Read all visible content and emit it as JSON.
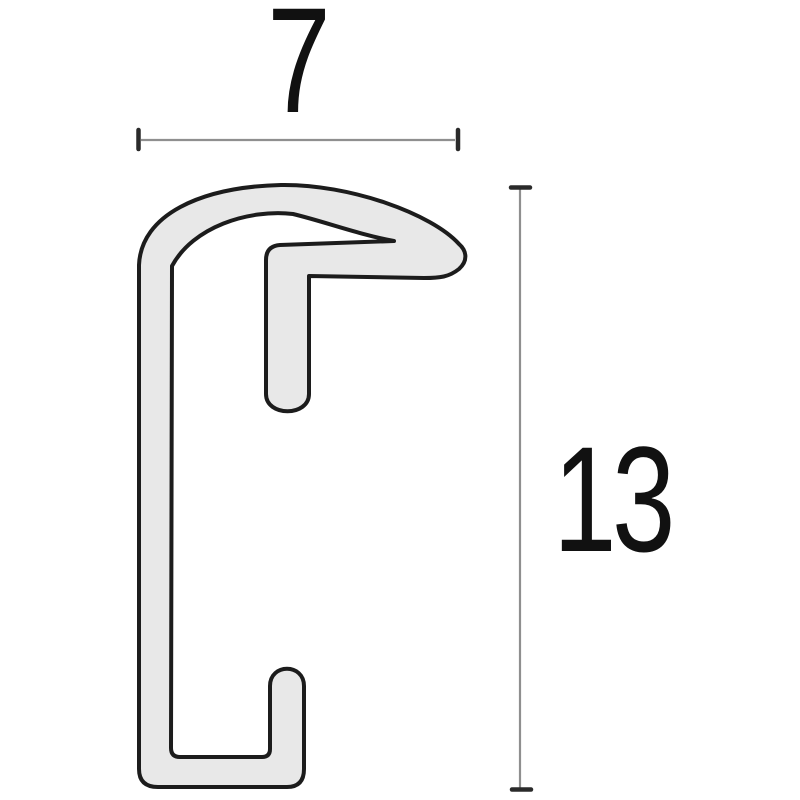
{
  "figure": {
    "name": "frame-moulding-profile-cross-section",
    "background_color": "#ffffff",
    "profile_fill_color": "#e8e8e8",
    "profile_outline_color": "#1c1c1c"
  },
  "dimensions": {
    "width_label": "7",
    "height_label": "13",
    "dimension_line_color": "#8f8f8f",
    "tick_color": "#2a2a2a",
    "label_color": "#111111"
  }
}
